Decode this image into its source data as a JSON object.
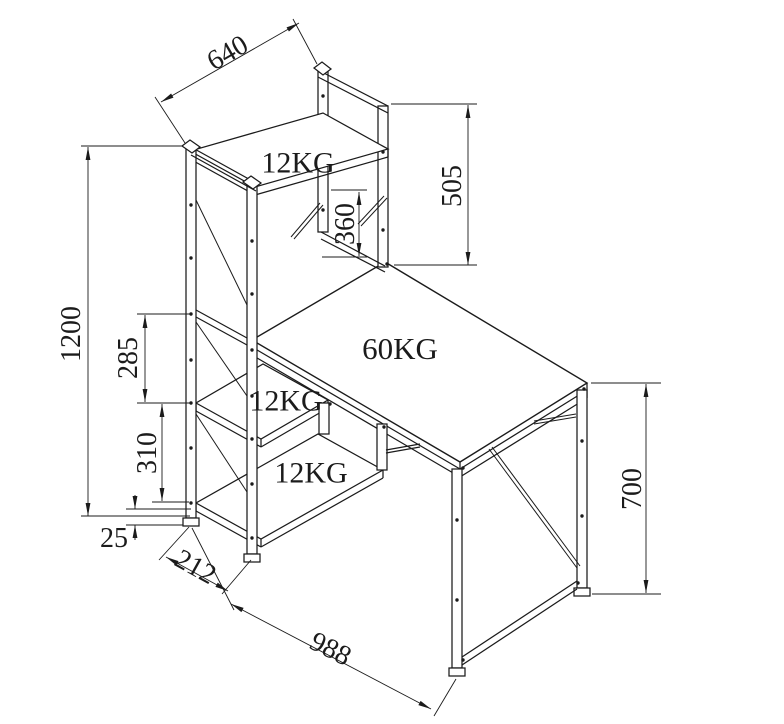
{
  "drawing": {
    "canvas": {
      "width": 784,
      "height": 724,
      "background": "#ffffff",
      "line_color": "#1b1b1b"
    },
    "load_labels": [
      {
        "name": "top-shelf-load",
        "text": "12KG",
        "x": 298,
        "y": 162,
        "size": 30
      },
      {
        "name": "desktop-load",
        "text": "60KG",
        "x": 400,
        "y": 348,
        "size": 31
      },
      {
        "name": "middle-shelf-load",
        "text": "12KG",
        "x": 286,
        "y": 400,
        "size": 30
      },
      {
        "name": "bottom-shelf-load",
        "text": "12KG",
        "x": 311,
        "y": 472,
        "size": 30
      }
    ],
    "dimensions": [
      {
        "name": "shelf-depth-top",
        "value": "640",
        "tx": 227,
        "ty": 52,
        "rot": -30,
        "line": [
          161,
          102,
          299,
          23
        ],
        "exts": [
          [
            185,
            143,
            155,
            97
          ],
          [
            317,
            64,
            293,
            19
          ]
        ]
      },
      {
        "name": "hutch-height",
        "value": "505",
        "tx": 451,
        "ty": 186,
        "rot": -90,
        "line": [
          468,
          105,
          468,
          265
        ],
        "exts": [
          [
            391,
            104,
            477,
            104
          ],
          [
            394,
            265,
            477,
            265
          ]
        ]
      },
      {
        "name": "clearance",
        "value": "360",
        "tx": 344,
        "ty": 224,
        "rot": -90,
        "line": [
          359,
          192,
          359,
          256
        ],
        "exts": [
          [
            331,
            190,
            367,
            190
          ],
          [
            322,
            257,
            367,
            257
          ]
        ]
      },
      {
        "name": "tower-height",
        "value": "1200",
        "tx": 70,
        "ty": 334,
        "rot": -90,
        "line": [
          88,
          147,
          88,
          516
        ],
        "exts": [
          [
            183,
            146,
            81,
            146
          ],
          [
            190,
            516,
            81,
            516
          ]
        ]
      },
      {
        "name": "gap-upper",
        "value": "285",
        "tx": 127,
        "ty": 358,
        "rot": -90,
        "line": [
          145,
          315,
          145,
          402
        ],
        "exts": [
          [
            191,
            314,
            137,
            314
          ],
          [
            191,
            403,
            137,
            403
          ]
        ]
      },
      {
        "name": "gap-lower",
        "value": "310",
        "tx": 146,
        "ty": 453,
        "rot": -90,
        "line": [
          162,
          404,
          162,
          501
        ],
        "exts": [
          [
            152,
            502,
            189,
            502
          ]
        ]
      },
      {
        "name": "floor-clearance",
        "value": "25",
        "tx": 114,
        "ty": 537,
        "rot": 0,
        "arrow_lines": [
          [
            135,
            495,
            135,
            509
          ],
          [
            135,
            540,
            135,
            525
          ]
        ],
        "exts": [
          [
            126,
            509,
            191,
            509
          ],
          [
            126,
            525,
            183,
            525
          ]
        ]
      },
      {
        "name": "tower-depth",
        "value": "212",
        "tx": 196,
        "ty": 566,
        "rot": 29,
        "line": [
          166,
          557,
          228,
          591
        ],
        "exts": [
          [
            189,
            527,
            159,
            560
          ],
          [
            251,
            560,
            222,
            594
          ]
        ]
      },
      {
        "name": "desk-length",
        "value": "988",
        "tx": 331,
        "ty": 648,
        "rot": 27,
        "line": [
          231,
          604,
          431,
          709
        ],
        "exts": [
          [
            192,
            528,
            234,
            610
          ],
          [
            456,
            679,
            434,
            716
          ]
        ]
      },
      {
        "name": "desk-height",
        "value": "700",
        "tx": 631,
        "ty": 489,
        "rot": -90,
        "line": [
          646,
          384,
          646,
          593
        ],
        "exts": [
          [
            591,
            383,
            661,
            383
          ],
          [
            592,
            594,
            661,
            594
          ]
        ]
      }
    ],
    "structure": [
      {
        "t": "p",
        "n": "bottom-shelf",
        "pts": [
          [
            196,
            503
          ],
          [
            261,
            539
          ],
          [
            383,
            470
          ],
          [
            318,
            434
          ]
        ]
      },
      {
        "t": "l",
        "p": [
          196,
          503,
          196,
          511
        ]
      },
      {
        "t": "l",
        "p": [
          196,
          511,
          261,
          547
        ]
      },
      {
        "t": "l",
        "p": [
          261,
          539,
          261,
          547
        ]
      },
      {
        "t": "l",
        "p": [
          261,
          547,
          383,
          478
        ]
      },
      {
        "t": "l",
        "p": [
          383,
          470,
          383,
          478
        ]
      },
      {
        "t": "p",
        "n": "middle-shelf",
        "pts": [
          [
            196,
            403
          ],
          [
            261,
            439
          ],
          [
            328,
            400
          ],
          [
            263,
            364
          ]
        ]
      },
      {
        "t": "l",
        "p": [
          196,
          403,
          196,
          411
        ]
      },
      {
        "t": "l",
        "p": [
          196,
          411,
          261,
          447
        ]
      },
      {
        "t": "l",
        "p": [
          261,
          439,
          261,
          447
        ]
      },
      {
        "t": "l",
        "p": [
          261,
          447,
          328,
          408
        ]
      },
      {
        "t": "l",
        "p": [
          328,
          400,
          328,
          408
        ]
      },
      {
        "t": "p",
        "n": "desktop",
        "pts": [
          [
            252,
            340
          ],
          [
            385,
            262
          ],
          [
            587,
            383
          ],
          [
            460,
            462
          ]
        ],
        "w": 1.4
      },
      {
        "t": "l",
        "p": [
          252,
          340,
          252,
          356
        ]
      },
      {
        "t": "l",
        "p": [
          252,
          347,
          460,
          469
        ]
      },
      {
        "t": "l",
        "p": [
          252,
          355,
          460,
          477
        ]
      },
      {
        "t": "l",
        "p": [
          460,
          462,
          460,
          477
        ]
      },
      {
        "t": "l",
        "p": [
          460,
          469,
          587,
          390
        ]
      },
      {
        "t": "l",
        "p": [
          460,
          477,
          587,
          398
        ]
      },
      {
        "t": "l",
        "p": [
          587,
          383,
          587,
          398
        ]
      },
      {
        "t": "p",
        "n": "shelf-hanger-post-inner",
        "pts": [
          [
            319,
            403
          ],
          [
            329,
            403
          ],
          [
            329,
            434
          ],
          [
            319,
            434
          ]
        ]
      },
      {
        "t": "p",
        "n": "shelf-hanger-post-outer",
        "pts": [
          [
            377,
            424
          ],
          [
            387,
            424
          ],
          [
            387,
            470
          ],
          [
            377,
            470
          ]
        ]
      },
      {
        "t": "l",
        "p": [
          386,
          450,
          420,
          444
        ]
      },
      {
        "t": "l",
        "p": [
          386,
          453,
          420,
          447
        ]
      },
      {
        "t": "p",
        "n": "front-leg",
        "pts": [
          [
            452,
            469
          ],
          [
            462,
            469
          ],
          [
            462,
            668
          ],
          [
            452,
            668
          ]
        ]
      },
      {
        "t": "p",
        "n": "front-leg-foot",
        "pts": [
          [
            449,
            668
          ],
          [
            465,
            668
          ],
          [
            465,
            676
          ],
          [
            449,
            676
          ]
        ]
      },
      {
        "t": "p",
        "n": "right-leg",
        "pts": [
          [
            577,
            390
          ],
          [
            587,
            390
          ],
          [
            587,
            588
          ],
          [
            577,
            588
          ]
        ]
      },
      {
        "t": "p",
        "n": "right-leg-foot",
        "pts": [
          [
            574,
            588
          ],
          [
            590,
            588
          ],
          [
            590,
            596
          ],
          [
            574,
            596
          ]
        ]
      },
      {
        "t": "l",
        "p": [
          462,
          657,
          577,
          581
        ]
      },
      {
        "t": "l",
        "p": [
          462,
          665,
          577,
          589
        ]
      },
      {
        "t": "l",
        "p": [
          489,
          449,
          577,
          568
        ],
        "w": 1
      },
      {
        "t": "l",
        "p": [
          492,
          447,
          580,
          566
        ],
        "w": 1
      },
      {
        "t": "l",
        "p": [
          534,
          421,
          576,
          414
        ],
        "w": 1
      },
      {
        "t": "l",
        "p": [
          534,
          424,
          576,
          417
        ],
        "w": 1
      },
      {
        "t": "p",
        "n": "hutch-back-left-post",
        "pts": [
          [
            318,
            70
          ],
          [
            328,
            70
          ],
          [
            328,
            232
          ],
          [
            318,
            232
          ]
        ]
      },
      {
        "t": "p",
        "n": "hutch-back-right-post",
        "pts": [
          [
            378,
            106
          ],
          [
            388,
            106
          ],
          [
            388,
            267
          ],
          [
            378,
            267
          ]
        ]
      },
      {
        "t": "l",
        "p": [
          318,
          70,
          388,
          106
        ]
      },
      {
        "t": "l",
        "p": [
          318,
          77,
          388,
          113
        ]
      },
      {
        "t": "l",
        "p": [
          321,
          232,
          385,
          266
        ]
      },
      {
        "t": "l",
        "p": [
          321,
          239,
          385,
          272
        ]
      },
      {
        "t": "p",
        "n": "hutch-post-cap",
        "pts": [
          [
            314,
            68
          ],
          [
            322,
            62
          ],
          [
            331,
            69
          ],
          [
            323,
            75
          ]
        ]
      },
      {
        "t": "p",
        "n": "hutch-shelf-board",
        "pts": [
          [
            190,
            151
          ],
          [
            255,
            187
          ],
          [
            388,
            149
          ],
          [
            323,
            113
          ]
        ]
      },
      {
        "t": "l",
        "p": [
          190,
          151,
          190,
          159
        ]
      },
      {
        "t": "l",
        "p": [
          190,
          159,
          255,
          195
        ]
      },
      {
        "t": "l",
        "p": [
          255,
          187,
          255,
          195
        ]
      },
      {
        "t": "l",
        "p": [
          255,
          195,
          388,
          157
        ]
      },
      {
        "t": "l",
        "p": [
          388,
          149,
          388,
          157
        ]
      },
      {
        "t": "l",
        "p": [
          291,
          237,
          320,
          203
        ],
        "w": 1
      },
      {
        "t": "l",
        "p": [
          294,
          239,
          323,
          205
        ],
        "w": 1
      },
      {
        "t": "l",
        "p": [
          358,
          224,
          384,
          196
        ],
        "w": 1
      },
      {
        "t": "l",
        "p": [
          361,
          226,
          387,
          198
        ],
        "w": 1
      },
      {
        "t": "p",
        "n": "tower-left-post",
        "pts": [
          [
            186,
            148
          ],
          [
            196,
            148
          ],
          [
            196,
            518
          ],
          [
            186,
            518
          ]
        ]
      },
      {
        "t": "p",
        "n": "tower-right-post",
        "pts": [
          [
            247,
            184
          ],
          [
            257,
            184
          ],
          [
            257,
            554
          ],
          [
            247,
            554
          ]
        ]
      },
      {
        "t": "l",
        "p": [
          191,
          147,
          256,
          183
        ]
      },
      {
        "t": "l",
        "p": [
          191,
          155,
          256,
          191
        ]
      },
      {
        "t": "p",
        "n": "tower-left-cap",
        "pts": [
          [
            182,
            146
          ],
          [
            190,
            140
          ],
          [
            200,
            147
          ],
          [
            192,
            153
          ]
        ]
      },
      {
        "t": "p",
        "n": "tower-right-cap",
        "pts": [
          [
            243,
            182
          ],
          [
            251,
            176
          ],
          [
            261,
            183
          ],
          [
            253,
            189
          ]
        ]
      },
      {
        "t": "p",
        "n": "tower-left-foot",
        "pts": [
          [
            183,
            518
          ],
          [
            199,
            518
          ],
          [
            199,
            526
          ],
          [
            183,
            526
          ]
        ]
      },
      {
        "t": "p",
        "n": "tower-right-foot",
        "pts": [
          [
            244,
            554
          ],
          [
            260,
            554
          ],
          [
            260,
            562
          ],
          [
            244,
            562
          ]
        ]
      },
      {
        "t": "l",
        "p": [
          196,
          310,
          247,
          338
        ]
      },
      {
        "t": "l",
        "p": [
          196,
          317,
          247,
          345
        ]
      },
      {
        "t": "l",
        "p": [
          196,
          200,
          247,
          305
        ],
        "w": 1
      },
      {
        "t": "l",
        "p": [
          196,
          322,
          247,
          396
        ],
        "w": 1
      },
      {
        "t": "l",
        "p": [
          196,
          414,
          247,
          492
        ],
        "w": 1
      },
      {
        "t": "d",
        "c": [
          191,
          205
        ]
      },
      {
        "t": "d",
        "c": [
          191,
          258
        ]
      },
      {
        "t": "d",
        "c": [
          191,
          314
        ]
      },
      {
        "t": "d",
        "c": [
          191,
          360
        ]
      },
      {
        "t": "d",
        "c": [
          191,
          403
        ]
      },
      {
        "t": "d",
        "c": [
          191,
          448
        ]
      },
      {
        "t": "d",
        "c": [
          191,
          503
        ]
      },
      {
        "t": "d",
        "c": [
          252,
          241
        ]
      },
      {
        "t": "d",
        "c": [
          252,
          294
        ]
      },
      {
        "t": "d",
        "c": [
          252,
          350
        ]
      },
      {
        "t": "d",
        "c": [
          252,
          396
        ]
      },
      {
        "t": "d",
        "c": [
          252,
          439
        ]
      },
      {
        "t": "d",
        "c": [
          252,
          484
        ]
      },
      {
        "t": "d",
        "c": [
          252,
          538
        ]
      },
      {
        "t": "d",
        "c": [
          323,
          96
        ]
      },
      {
        "t": "d",
        "c": [
          323,
          210
        ]
      },
      {
        "t": "d",
        "c": [
          383,
          152
        ]
      },
      {
        "t": "d",
        "c": [
          383,
          230
        ]
      },
      {
        "t": "d",
        "c": [
          457,
          520
        ]
      },
      {
        "t": "d",
        "c": [
          457,
          600
        ]
      },
      {
        "t": "d",
        "c": [
          582,
          441
        ]
      },
      {
        "t": "d",
        "c": [
          582,
          516
        ]
      },
      {
        "t": "d",
        "c": [
          463,
          468
        ]
      },
      {
        "t": "d",
        "c": [
          584,
          389
        ]
      },
      {
        "t": "d",
        "c": [
          387,
          264
        ]
      },
      {
        "t": "d",
        "c": [
          330,
          404
        ]
      },
      {
        "t": "d",
        "c": [
          384,
          427
        ]
      },
      {
        "t": "d",
        "c": [
          463,
          660
        ]
      },
      {
        "t": "d",
        "c": [
          578,
          583
        ]
      }
    ],
    "dim_font_size": 28
  }
}
